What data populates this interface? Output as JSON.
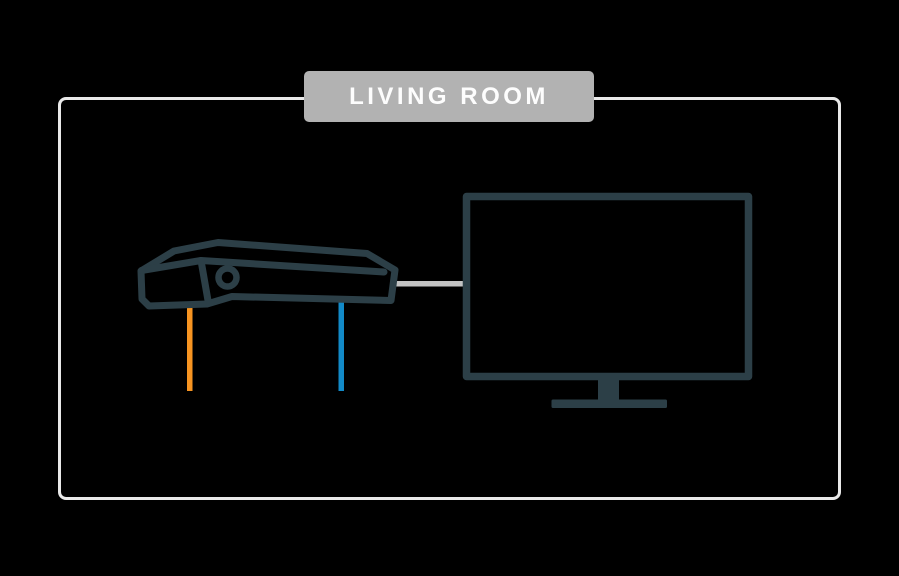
{
  "room": {
    "label": "LIVING ROOM"
  },
  "icons": {
    "set_top_box": "set-top-box-icon",
    "tv": "tv-icon",
    "orange_cable": "orange-cable",
    "blue_cable": "blue-cable",
    "gray_cable": "connection-cable"
  },
  "colors": {
    "background": "#000000",
    "outline": "#2C3F47",
    "orange_cable": "#F79421",
    "blue_cable": "#128AC8",
    "gray_cable": "#C3C3C3",
    "label_bg": "#B2B2B2",
    "label_text": "#FDFDFD",
    "room_border": "#E9E9E9"
  }
}
